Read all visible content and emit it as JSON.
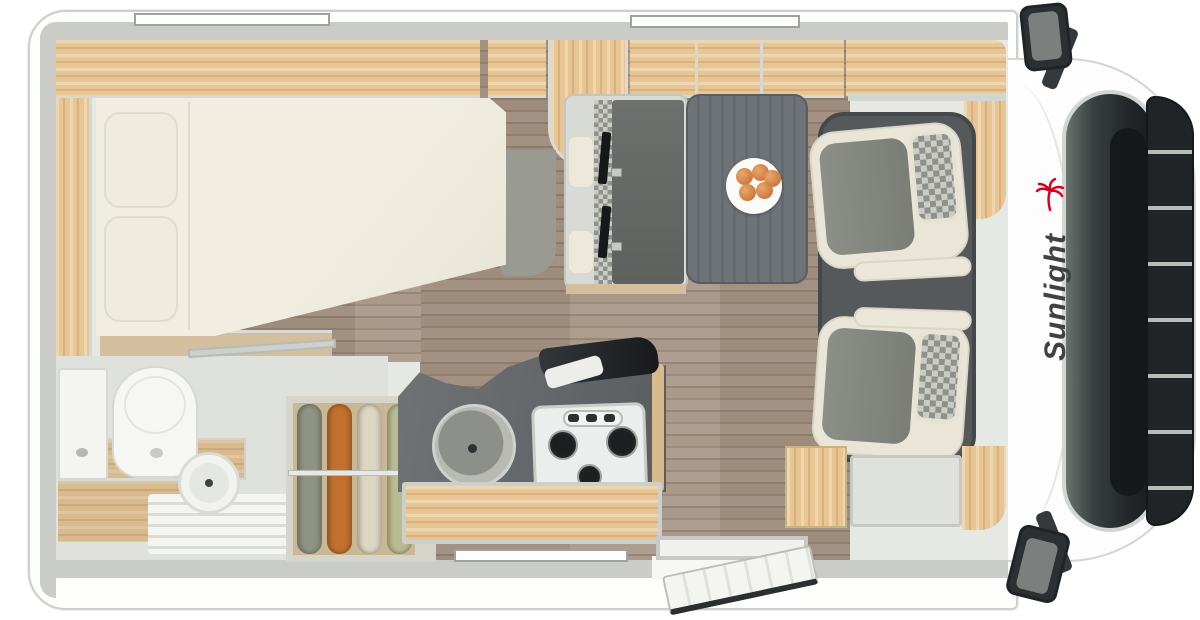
{
  "brand": {
    "logo_text": "Sunlight",
    "logo_text_color": "#414144",
    "palm_icon_color": "#d5001c"
  },
  "colors": {
    "wall": "#c9ccc7",
    "interior": "#e6e8e3",
    "wood": "#e7c693",
    "woodmid": "#d8ba8c",
    "woodlight": "#d3bf9d",
    "floor": "#a28e7d",
    "mattress": "#f1eee1",
    "counter": "#65696b",
    "table": "#6e7378",
    "mat": "#55595b",
    "seatcream": "#e9e6d8",
    "seatgrey": "#868881",
    "checklight": "#cbccc5",
    "checkdark": "#8f918b",
    "belt": "#17181a",
    "toilet": "#f6f7f3",
    "windshield": "#23272a",
    "grille": "#202427",
    "fruit": "#d0793f",
    "g1": "#8f9383",
    "g2": "#c0712e",
    "g3": "#ddd6c2",
    "g4": "#b9bc92",
    "logotext": "#414144",
    "logored": "#d5001c"
  }
}
